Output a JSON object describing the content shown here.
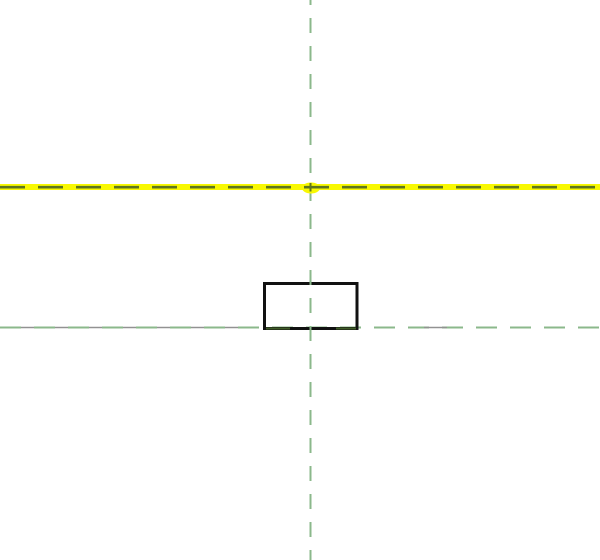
{
  "app_context": "cad-drawing-canvas",
  "canvas": {
    "width": 600,
    "height": 560,
    "background_color": "#ffffff"
  },
  "colors": {
    "reference_plane_green": "#8bb88b",
    "overlap_gray": "#929292",
    "selection_highlight_yellow": "#f8f802",
    "highlight_dash_olive": "#5e751e",
    "sketch_black": "#111111",
    "overlap_dark_green": "#3f5c28",
    "none": "none"
  },
  "elements": {
    "vertical_reference_plane": {
      "x": 310.5,
      "y1": 0,
      "y2": 560,
      "stroke_width": 2,
      "dash": "15 13",
      "dash_offset": 10
    },
    "horizontal_reference_plane": {
      "y": 327.5,
      "x1": 0,
      "x2": 600,
      "stroke_width": 2,
      "dash": "21 13",
      "dash_offset": 0
    },
    "horizontal_gray_overlap": {
      "y": 327.5,
      "x1": 0,
      "x2": 252,
      "stroke_width": 1.6,
      "dash": "13 21",
      "dash_offset": -21
    },
    "gray_dash_right": {
      "y": 327.5,
      "x1": 424,
      "x2": 447,
      "stroke_width": 1.6
    },
    "highlighted_reference_plane": {
      "band_x": 0,
      "band_y": 184,
      "band_width": 600,
      "band_height": 6,
      "dash_y": 187.2,
      "dash_x1": 0,
      "dash_x2": 600,
      "dash_stroke_width": 2.6,
      "dash": "25 13",
      "origin_marker": {
        "cx": 311,
        "cy": 188,
        "rx": 9,
        "ry": 5.5
      },
      "stub_x": 310.5,
      "stub_y1": 183,
      "stub_y2": 191.5,
      "stub_width": 2
    },
    "sketch_rectangle": {
      "x": 264.5,
      "y": 283.5,
      "width": 92.5,
      "height": 45,
      "stroke_width": 3
    },
    "bottom_edge_overlap_dash_1": {
      "y": 328.5,
      "x1": 266,
      "x2": 290,
      "stroke_width": 2
    },
    "bottom_edge_overlap_dash_2": {
      "y": 328.5,
      "x1": 336,
      "x2": 356,
      "stroke_width": 2
    }
  }
}
